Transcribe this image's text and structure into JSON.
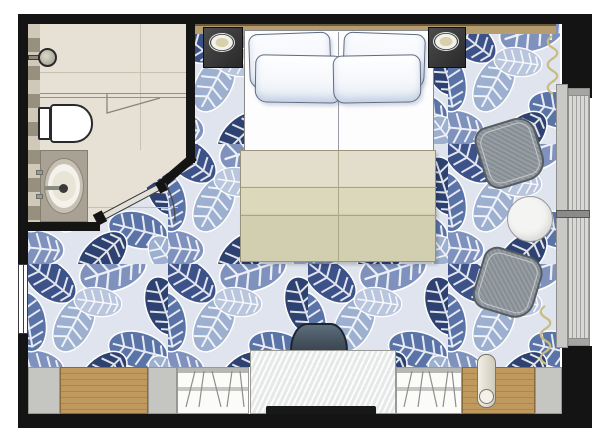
{
  "title": "stateroom-floor-plan",
  "plan": {
    "rooms": [
      {
        "name": "bathroom",
        "fixtures": [
          "shower-head",
          "shower-glass",
          "toilet",
          "vanity-sink",
          "swing-door"
        ]
      },
      {
        "name": "bedroom",
        "furniture": [
          "headboard-ledge",
          "twin-bed-left",
          "twin-bed-right",
          "pillows",
          "foot-blanket",
          "nightstand-left",
          "nightstand-right",
          "table-lamp-left",
          "table-lamp-right",
          "armchair-top",
          "armchair-bottom",
          "round-side-table",
          "dresser-wood",
          "cabinet-gray-left",
          "cabinet-gray-mid",
          "wardrobe-left",
          "wardrobe-right",
          "desk-marble",
          "desk-chair",
          "tv-bar",
          "wood-counter-right",
          "floor-lamp-column",
          "balcony-sliding-door",
          "curtain-top",
          "curtain-bottom",
          "left-wall-opening"
        ]
      }
    ]
  },
  "colors": {
    "wall": "#141414",
    "margin_bg": "#ffffff",
    "carpet_bg": "#dfe4ee",
    "leaf_dark": "#2e4271",
    "leaf_navy": "#3c5288",
    "leaf_mid": "#5b74a8",
    "leaf_soft": "#7e92bd",
    "leaf_light": "#9db0d0",
    "leaf_pale": "#b9c6dd",
    "tile": "#e6e1d4",
    "grout": "#c9c2b2",
    "tile_taupe": "#97907f",
    "tile_light": "#d0c9b9",
    "headboard": "#b59d70",
    "lamp_center": "#d9d0a9",
    "bed_white": "#fdfdfe",
    "pillow_outline": "#5f6b80",
    "blanket": "#dcd8bc",
    "blanket_line": "#a8a489",
    "chair_gray": "#8d959b",
    "chair_border": "#555c62",
    "table_white": "#f4f4f2",
    "desk_marble": "#f2f4f3",
    "wood": "#c0995e",
    "cabinet_gray": "#c5c5c1",
    "wardrobe_white": "#fbfbfa",
    "wardrobe_band": "#b7b7b3",
    "slash_gray": "#8e8e8a",
    "tv_black": "#181818",
    "door_sill": "#c9c9c6",
    "door_panel": "#d8d8d6",
    "door_panel_line": "#a0a09e",
    "handle_gray": "#8b8b89",
    "curtain": "#c9bc80",
    "fixture_outline": "#2a2a2a",
    "vanity": "#a9a294",
    "arc_line": "#4a4a4a"
  }
}
